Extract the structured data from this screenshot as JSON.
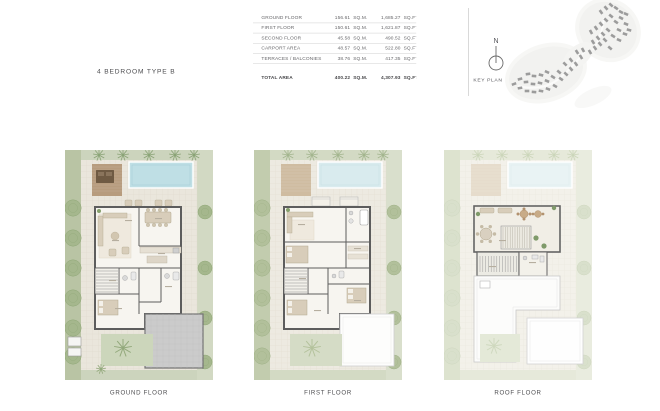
{
  "page": {
    "title": "4 BEDROOM TYPE B"
  },
  "area_table": {
    "rows": [
      {
        "label": "GROUND FLOOR",
        "sqm": "156.61",
        "sqm_unit": "SQ.M.",
        "sqft": "1,685.27",
        "sqft_unit": "SQ.FT."
      },
      {
        "label": "FIRST FLOOR",
        "sqm": "150.61",
        "sqm_unit": "SQ.M.",
        "sqft": "1,621.87",
        "sqft_unit": "SQ.FT."
      },
      {
        "label": "SECOND FLOOR",
        "sqm": "45.58",
        "sqm_unit": "SQ.M.",
        "sqft": "490.52",
        "sqft_unit": "SQ.FT."
      },
      {
        "label": "CARPORT AREA",
        "sqm": "48.57",
        "sqm_unit": "SQ.M.",
        "sqft": "522.80",
        "sqft_unit": "SQ.FT."
      },
      {
        "label": "TERRACES / BALCONIES",
        "sqm": "38.76",
        "sqm_unit": "SQ.M.",
        "sqft": "417.35",
        "sqft_unit": "SQ.FT."
      }
    ],
    "total": {
      "label": "TOTAL AREA",
      "sqm": "400.22",
      "sqm_unit": "SQ.M.",
      "sqft": "4,307.93",
      "sqft_unit": "SQ.FT."
    }
  },
  "key_plan": {
    "label": "KEY PLAN",
    "north_label": "N"
  },
  "floors": [
    {
      "label": "GROUND FLOOR"
    },
    {
      "label": "FIRST FLOOR"
    },
    {
      "label": "ROOF FLOOR"
    }
  ],
  "colors": {
    "landscape_green": "#ccd4bd",
    "landscape_green_dark": "#b9c4a4",
    "terrace_beige": "#eae6dc",
    "pool_blue": "#bfdfe5",
    "deck_brown": "#b79c7e",
    "wall_gray": "#5d5d5d",
    "carport_gray": "#cbcbcb",
    "tree_green": "#a5b78d",
    "map_building_gray": "#8f8f8f",
    "text_dark": "#4c4c4f",
    "table_line": "#d8d8d8"
  }
}
